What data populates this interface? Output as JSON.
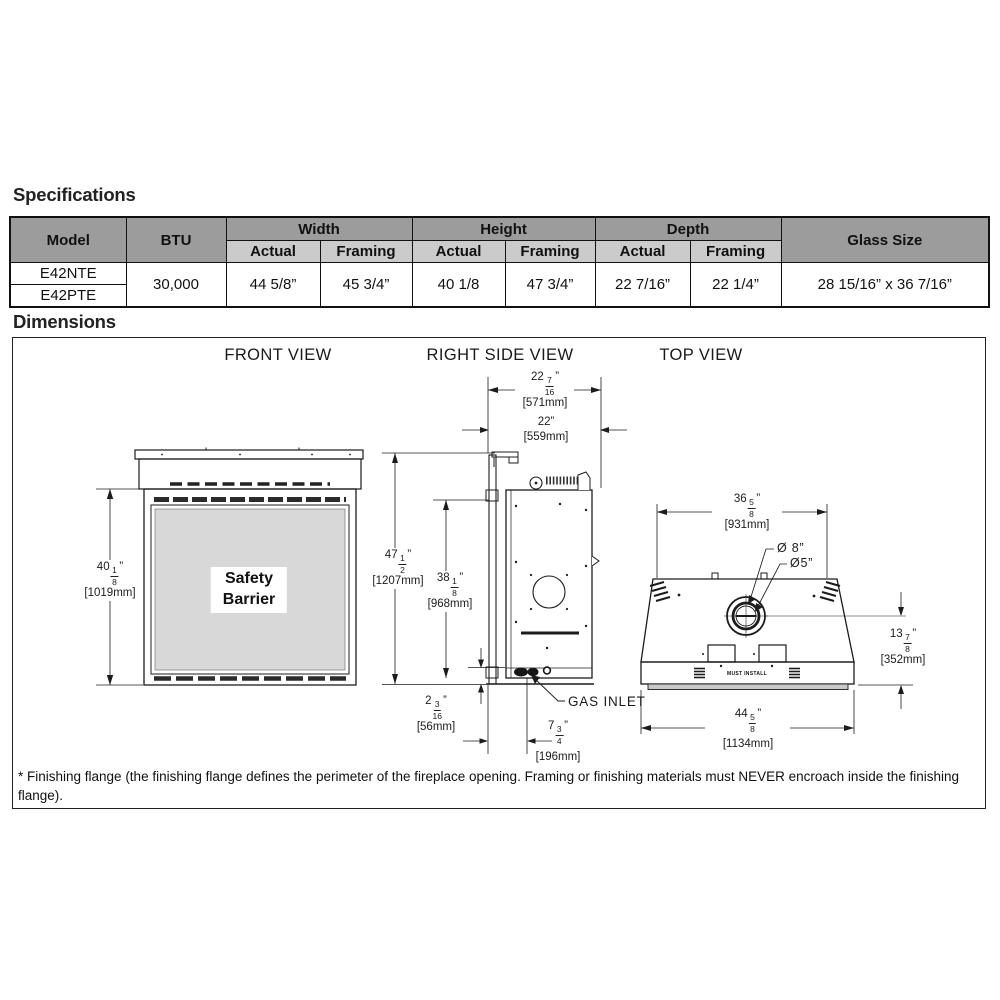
{
  "titles": {
    "specifications": "Specifications",
    "dimensions": "Dimensions"
  },
  "spec_table": {
    "col_model": "Model",
    "col_btu": "BTU",
    "col_width": "Width",
    "col_height": "Height",
    "col_depth": "Depth",
    "col_glass": "Glass Size",
    "sub_actual": "Actual",
    "sub_framing": "Framing",
    "models": [
      "E42NTE",
      "E42PTE"
    ],
    "btu": "30,000",
    "width_actual": "44 5/8”",
    "width_framing": "45 3/4”",
    "height_actual": "40 1/8",
    "height_framing": "47 3/4”",
    "depth_actual": "22 7/16”",
    "depth_framing": "22 1/4”",
    "glass_size": "28 15/16” x 36 7/16”"
  },
  "views": {
    "front_label": "FRONT VIEW",
    "side_label": "RIGHT SIDE VIEW",
    "top_label": "TOP VIEW",
    "safety_line1": "Safety",
    "safety_line2": "Barrier",
    "gas_inlet": "GAS INLET",
    "must_install": "MUST INSTALL",
    "dia_outer": "Ø 8”",
    "dia_inner": "Ø5”"
  },
  "dims": {
    "front_height": {
      "whole": "40",
      "num": "1",
      "den": "8",
      "unit": "”",
      "mm": "[1019mm]"
    },
    "side_total_height": {
      "whole": "47",
      "num": "1",
      "den": "2",
      "unit": "”",
      "mm": "[1207mm]"
    },
    "side_opening_height": {
      "whole": "38",
      "num": "1",
      "den": "8",
      "unit": "”",
      "mm": "[968mm]"
    },
    "depth_framing": {
      "whole": "22",
      "num": "7",
      "den": "16",
      "unit": "”",
      "mm": "[571mm]"
    },
    "depth_actual": {
      "text": "22”",
      "mm": "[559mm]"
    },
    "gas_inlet_height": {
      "whole": "2",
      "num": "3",
      "den": "16",
      "unit": "”",
      "mm": "[56mm]"
    },
    "gas_inlet_setback": {
      "whole": "7",
      "num": "3",
      "den": "4",
      "unit": "”",
      "mm": "[196mm]"
    },
    "top_rear_width": {
      "whole": "36",
      "num": "5",
      "den": "8",
      "unit": "”",
      "mm": "[931mm]"
    },
    "flue_center_to_front": {
      "whole": "13",
      "num": "7",
      "den": "8",
      "unit": "”",
      "mm": "[352mm]"
    },
    "front_width": {
      "whole": "44",
      "num": "5",
      "den": "8",
      "unit": "”",
      "mm": "[1134mm]"
    }
  },
  "footnote": "* Finishing flange (the finishing flange defines the perimeter of the fireplace opening. Framing or finishing materials must NEVER encroach inside the finishing flange).",
  "colors": {
    "header_dark": "#9c9c9c",
    "header_light": "#cbcbcb",
    "glass_fill": "#d8d8d8",
    "line": "#1c1c1c"
  }
}
